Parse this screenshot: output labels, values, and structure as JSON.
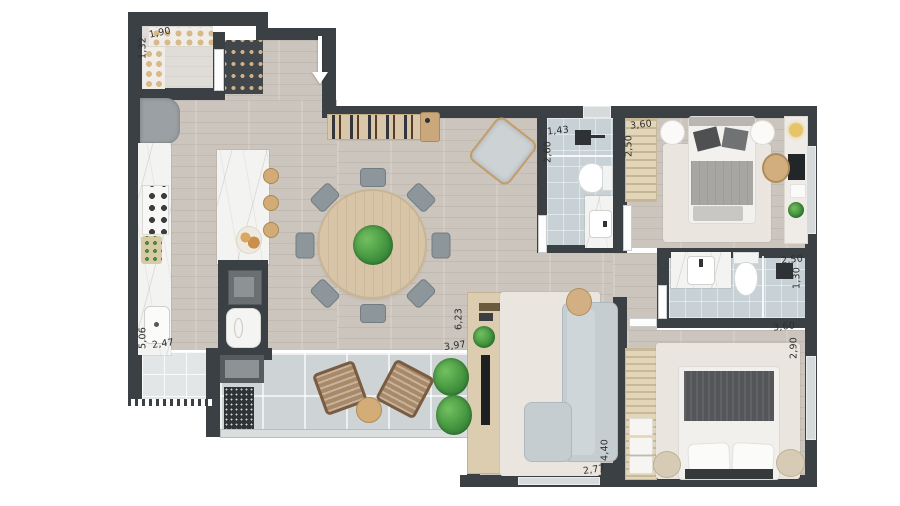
{
  "plan": {
    "unit_labels": {
      "pantry_width": "1,90",
      "pantry_depth": "1,32",
      "kitchen_length": "5,06",
      "kitchen_width": "2,47",
      "living_length": "6,23",
      "living_width": "3,97",
      "living_depth": "4,40",
      "living_span": "2,77",
      "bath1_width": "1,43",
      "bath1_length": "2,60",
      "bedroom1_width": "3,60",
      "bedroom1_closet_depth": "2,50",
      "bath2_width": "2,50",
      "bath2_depth": "1,30",
      "bedroom2_width": "3,60",
      "bedroom2_depth": "2,90"
    },
    "colors": {
      "wall": "#3a4044",
      "wood_floor": "#ccc5bd",
      "balcony_tile": "#ced4d5",
      "bath_tile": "#c8d1d5",
      "marble": "#f3f3f1",
      "rug": "#eae6df",
      "sofa": "#c5cdd1",
      "plant": "#3f913d"
    }
  }
}
